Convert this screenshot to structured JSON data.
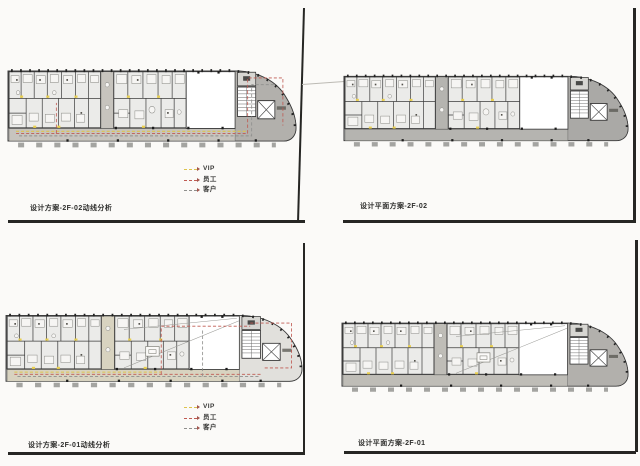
{
  "page": {
    "background_color": "#fbfaf8"
  },
  "colors": {
    "route_vip": "#ddc34d",
    "route_staff": "#bf5a52",
    "route_guest": "#8f8f8d",
    "zone_gray": "#b2b0ac",
    "zone_gray_dark": "#aaa9a6",
    "zone_gray_light": "#e1e0dc",
    "corridor_gray": "#c7c4be",
    "corridor_beige": "#d8d3c0",
    "wall": "#3c3c3c",
    "door_marker": "#e9cf4e",
    "frame_line": "#262624"
  },
  "panels": [
    {
      "id": "top-left",
      "title": "设计方案-2F-02动线分析",
      "floor": "2F-02",
      "kind": "circulation-analysis",
      "has_legend": true
    },
    {
      "id": "top-right",
      "title": "设计平面方案-2F-02",
      "floor": "2F-02",
      "kind": "floor-plan",
      "has_legend": false
    },
    {
      "id": "bottom-left",
      "title": "设计方案-2F-01动线分析",
      "floor": "2F-01",
      "kind": "circulation-analysis",
      "has_legend": true
    },
    {
      "id": "bottom-right",
      "title": "设计平面方案-2F-01",
      "floor": "2F-01",
      "kind": "floor-plan",
      "has_legend": false
    }
  ],
  "legend": {
    "items": [
      {
        "label": "VIP",
        "color": "#ddc34d"
      },
      {
        "label": "员工",
        "color": "#bf5a52"
      },
      {
        "label": "客户",
        "color": "#8f8f8d"
      }
    ]
  }
}
